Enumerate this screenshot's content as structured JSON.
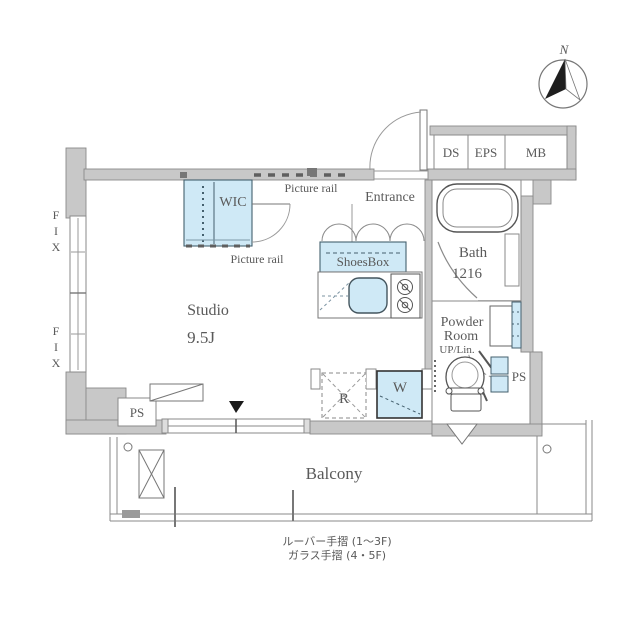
{
  "compass": {
    "north_label": "N"
  },
  "shafts": {
    "ds": "DS",
    "eps": "EPS",
    "mb": "MB"
  },
  "rooms": {
    "entrance": {
      "label": "Entrance"
    },
    "wic": {
      "label": "WIC"
    },
    "shoes_box": {
      "label": "ShoesBox"
    },
    "bath": {
      "label": "Bath",
      "size": "1216"
    },
    "powder_room": {
      "line1": "Powder",
      "line2": "Room",
      "line3": "UP/Lin."
    },
    "studio": {
      "label": "Studio",
      "size": "9.5J"
    },
    "balcony": {
      "label": "Balcony"
    }
  },
  "fixtures": {
    "refrigerator": "R",
    "washer": "W",
    "ps_left": "PS",
    "ps_right": "PS"
  },
  "annotations": {
    "picture_rail_top": "Picture rail",
    "picture_rail_bottom": "Picture rail",
    "fix": [
      "F",
      "I",
      "X"
    ],
    "handrail_note_1": "ルーバー手摺 (1〜3F)",
    "handrail_note_2": "ガラス手摺 (4・5F)"
  },
  "colors": {
    "wall_fill": "#c8c8c8",
    "wall_stroke": "#8a8a8a",
    "fixture_blue": "#cfe9f6",
    "fixture_blue_stroke": "#44606e",
    "line": "#808080",
    "text": "#5a5a5a"
  }
}
